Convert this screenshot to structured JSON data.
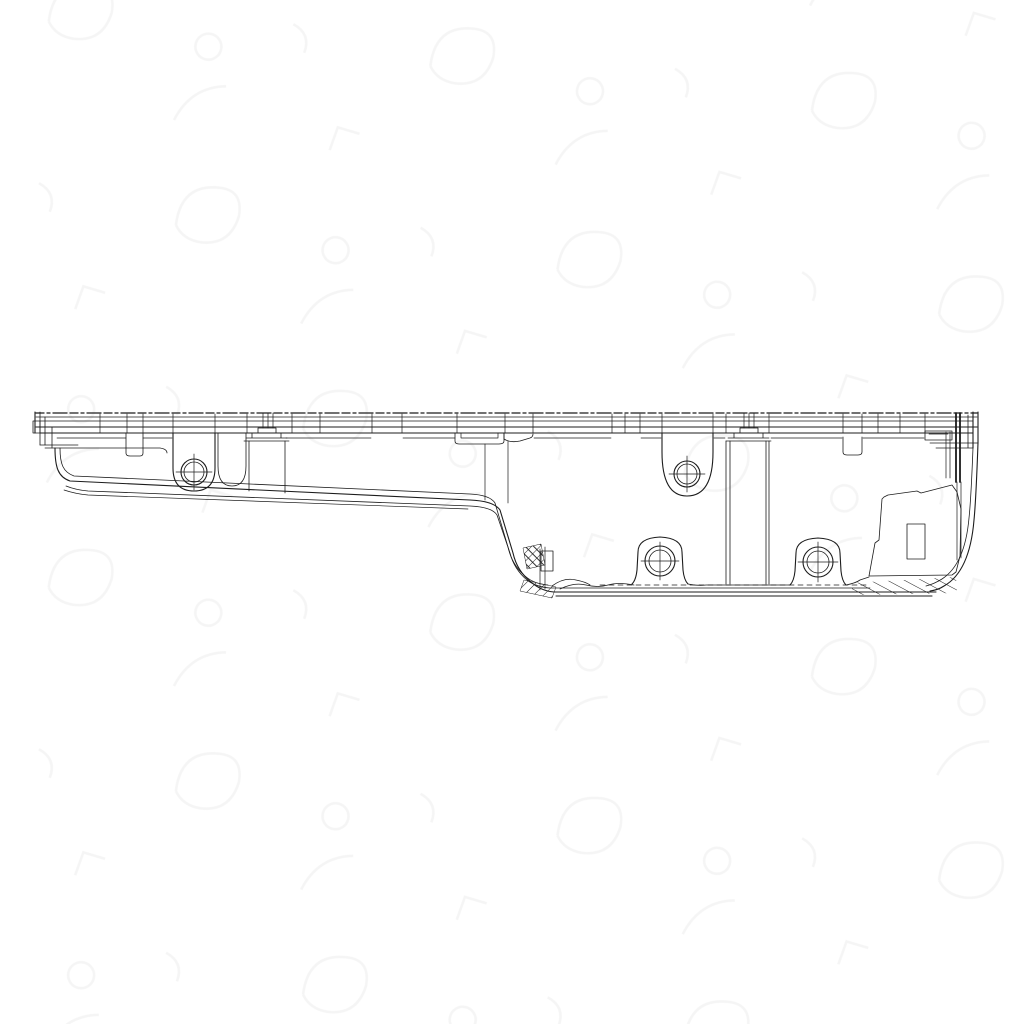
{
  "page": {
    "background_color": "#ffffff"
  },
  "drawing": {
    "aria_label": "Engine oil pan side profile technical line drawing",
    "line_color": "#1c1c1c",
    "background_color": "#ffffff",
    "watermark_color": "#ededed",
    "bolt_boss_count": 4,
    "hatch_region_count": 3,
    "features": [
      "top-mounting-flange-with-stitch-line",
      "left-end-cap",
      "shallow-sump-section",
      "step-down-transition",
      "deep-sump-section",
      "bolt-boss-shallow-left",
      "bolt-boss-deep-top",
      "bolt-boss-deep-bottom-left",
      "bolt-boss-deep-bottom-right",
      "drain-pad-panel",
      "right-end-wall",
      "gasket-hatching",
      "background-watermark"
    ]
  }
}
